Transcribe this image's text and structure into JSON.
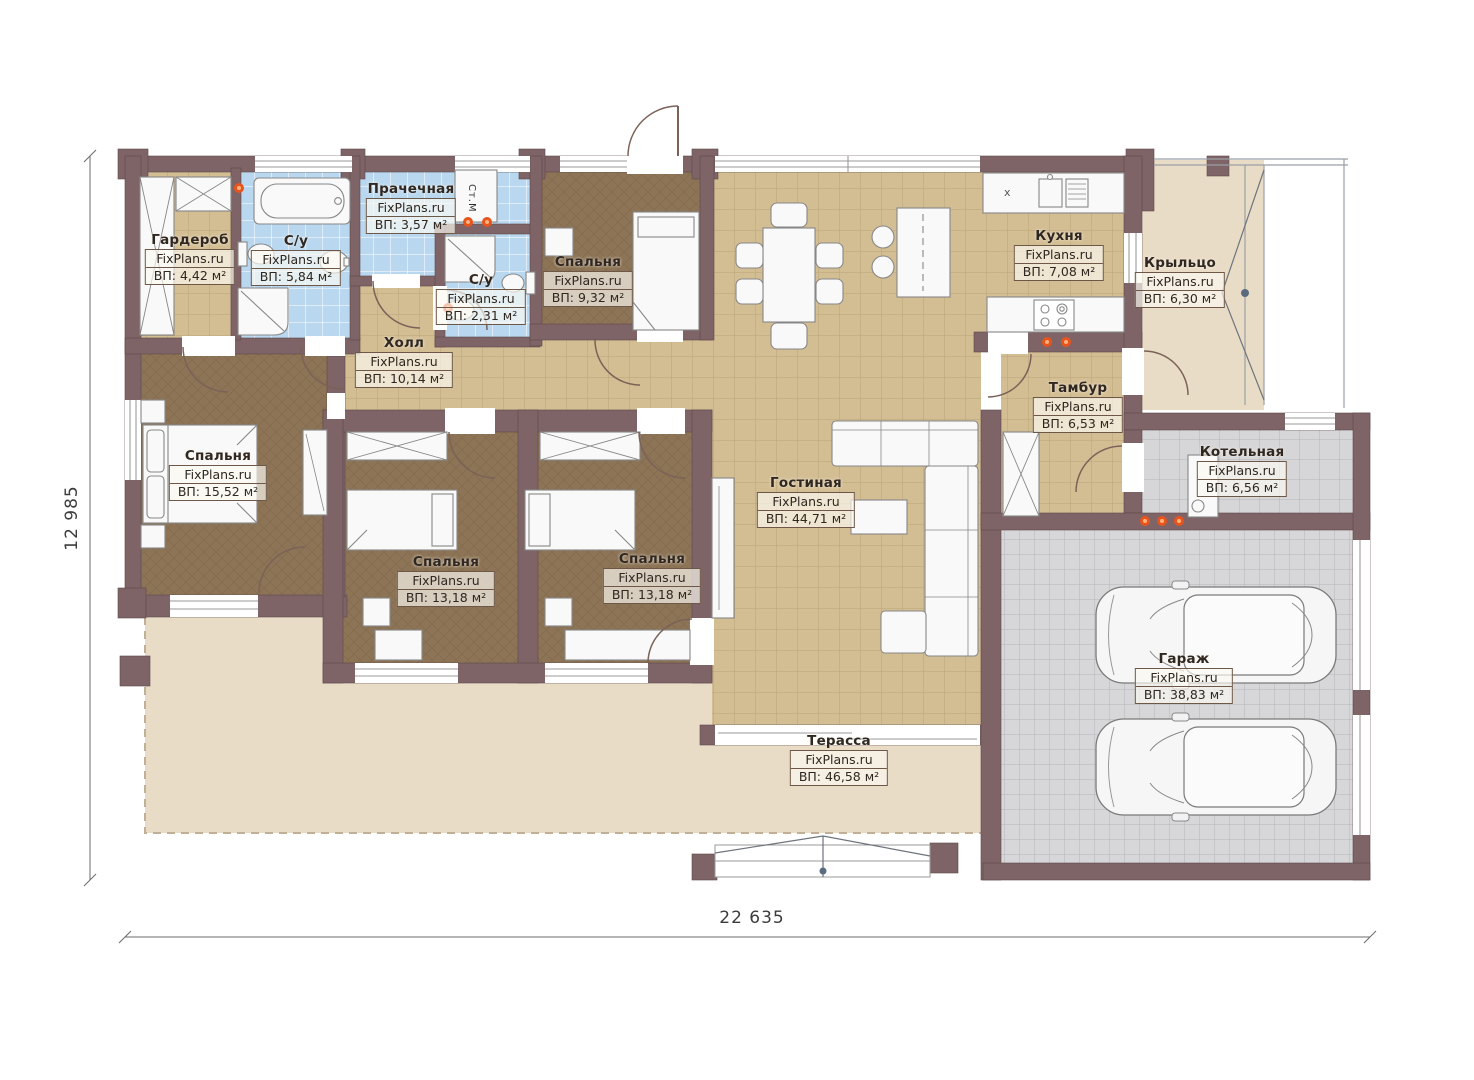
{
  "plan": {
    "watermark": "FixPlans.ru",
    "rooms": [
      {
        "id": "wardrobe",
        "name": "Гардероб",
        "area": "ВП: 4,42 м²"
      },
      {
        "id": "bathroom-1",
        "name": "С/у",
        "area": "ВП: 5,84 м²"
      },
      {
        "id": "laundry",
        "name": "Прачечная",
        "area": "ВП: 3,57 м²"
      },
      {
        "id": "bathroom-2",
        "name": "С/у",
        "area": "ВП: 2,31 м²"
      },
      {
        "id": "bedroom-small",
        "name": "Спальня",
        "area": "ВП: 9,32 м²"
      },
      {
        "id": "hall",
        "name": "Холл",
        "area": "ВП: 10,14 м²"
      },
      {
        "id": "kitchen",
        "name": "Кухня",
        "area": "ВП: 7,08 м²"
      },
      {
        "id": "porch",
        "name": "Крыльцо",
        "area": "ВП: 6,30 м²"
      },
      {
        "id": "vestibule",
        "name": "Тамбур",
        "area": "ВП: 6,53 м²"
      },
      {
        "id": "boiler-room",
        "name": "Котельная",
        "area": "ВП: 6,56 м²"
      },
      {
        "id": "living-room",
        "name": "Гостиная",
        "area": "ВП: 44,71 м²"
      },
      {
        "id": "bedroom-master",
        "name": "Спальня",
        "area": "ВП: 15,52 м²"
      },
      {
        "id": "bedroom-2",
        "name": "Спальня",
        "area": "ВП: 13,18 м²"
      },
      {
        "id": "bedroom-3",
        "name": "Спальня",
        "area": "ВП: 13,18 м²"
      },
      {
        "id": "garage",
        "name": "Гараж",
        "area": "ВП: 38,83 м²"
      },
      {
        "id": "terrace",
        "name": "Терасса",
        "area": "ВП: 46,58 м²"
      }
    ],
    "dimensions": {
      "width_mm": "22 635",
      "height_mm": "12 985"
    },
    "annotations": {
      "washing_machine": "Ст.М",
      "kitchen_cabinet_mark": "x"
    },
    "colors": {
      "wall": "#7e6466",
      "floor_tile_tan": "#d3bd93",
      "floor_tile_blue": "#b9d8f0",
      "floor_bedroom": "#8d7456",
      "floor_garage": "#d7d7d9",
      "terrace": "#e9dcc6",
      "marker": "#e8541d"
    }
  }
}
